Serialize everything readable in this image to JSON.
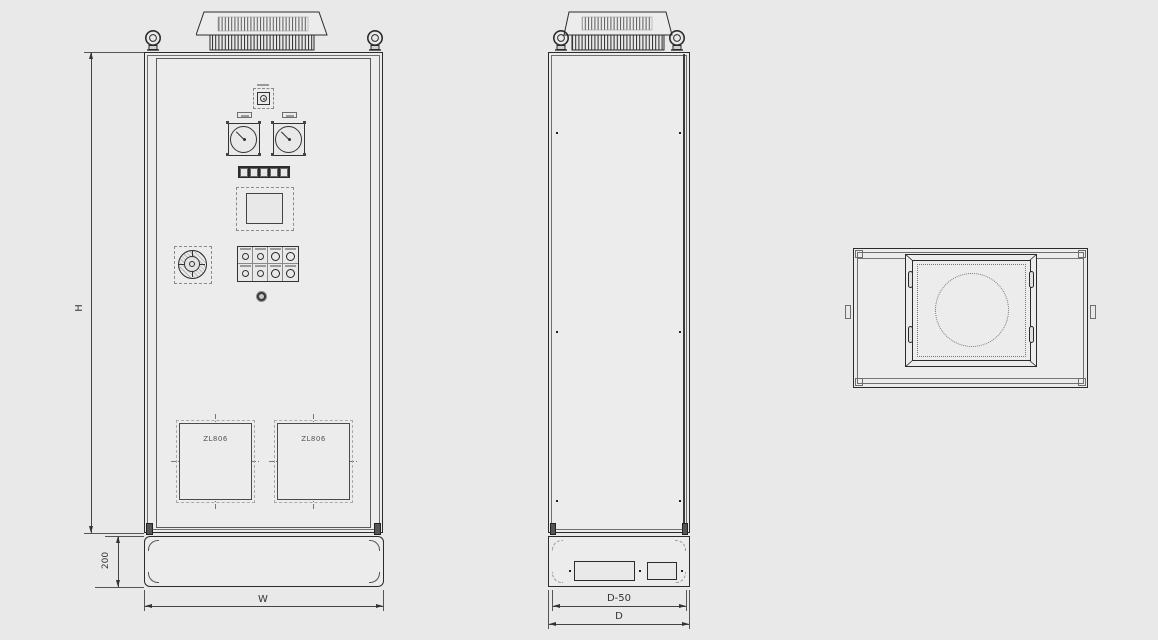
{
  "colors": {
    "background": "#e9e9e9",
    "line": "#2b2b2b",
    "dim_line": "#444"
  },
  "front_view": {
    "louver_left_label": "ZL806",
    "louver_right_label": "ZL806",
    "dim_height_label": "H",
    "dim_plinth_height_label": "200",
    "dim_width_label": "W"
  },
  "side_view": {
    "dim_depth_minor_label": "D-50",
    "dim_depth_label": "D"
  }
}
